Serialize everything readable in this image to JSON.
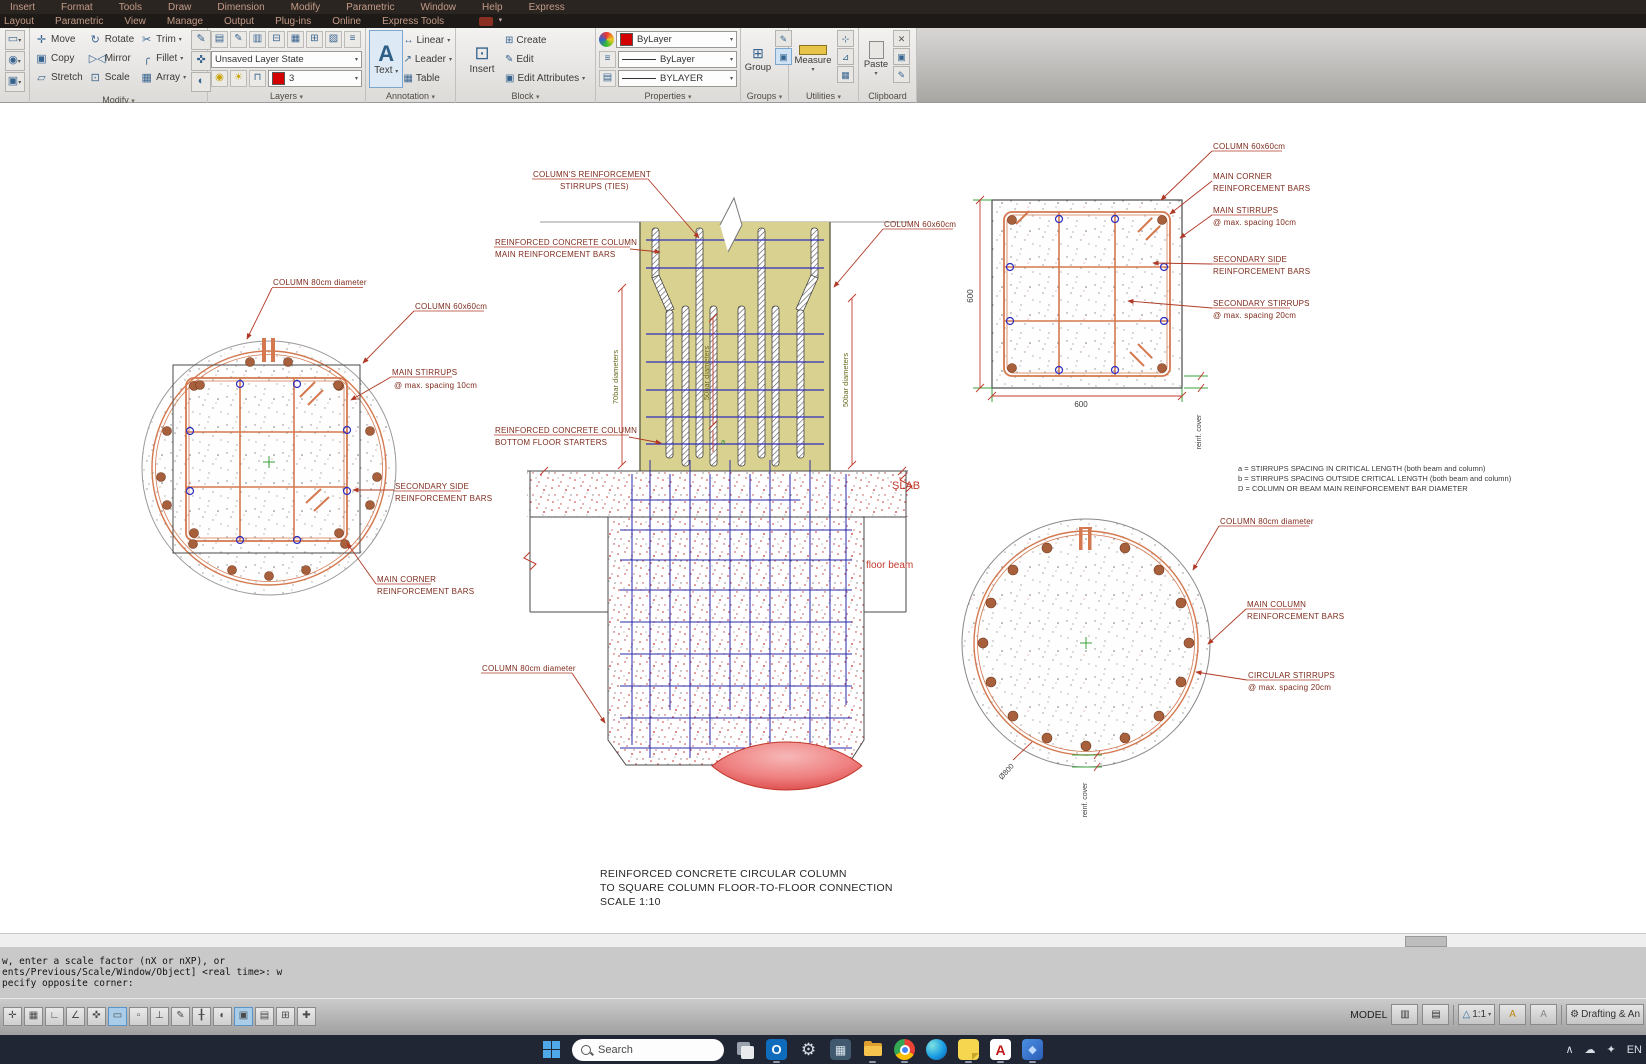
{
  "menubar": {
    "row1": [
      "Insert",
      "Format",
      "Tools",
      "Draw",
      "Dimension",
      "Modify",
      "Parametric",
      "Window",
      "Help",
      "Express"
    ],
    "row2": [
      "Layout",
      "Parametric",
      "View",
      "Manage",
      "Output",
      "Plug-ins",
      "Online",
      "Express Tools"
    ]
  },
  "ribbon": {
    "modify": {
      "label": "Modify",
      "move": "Move",
      "rotate": "Rotate",
      "trim": "Trim",
      "copy": "Copy",
      "mirror": "Mirror",
      "fillet": "Fillet",
      "stretch": "Stretch",
      "scale": "Scale",
      "array": "Array"
    },
    "layers": {
      "label": "Layers",
      "state": "Unsaved Layer State",
      "current": "3"
    },
    "annotation": {
      "label": "Annotation",
      "big_letter": "A",
      "text": "Text",
      "linear": "Linear",
      "leader": "Leader",
      "table": "Table"
    },
    "block": {
      "label": "Block",
      "insert": "Insert",
      "create": "Create",
      "edit": "Edit",
      "edit_attributes": "Edit Attributes"
    },
    "properties": {
      "label": "Properties",
      "color": "ByLayer",
      "linetype": "ByLayer",
      "lineweight": "BYLAYER"
    },
    "groups": {
      "label": "Groups",
      "group": "Group"
    },
    "utilities": {
      "label": "Utilities",
      "measure": "Measure"
    },
    "clipboard": {
      "label": "Clipboard",
      "paste": "Paste"
    }
  },
  "drawing": {
    "left_section": {
      "label_diameter": "COLUMN 80cm diameter",
      "label_column": "COLUMN 60x60cm",
      "label_stirrups1": "MAIN STIRRUPS",
      "label_stirrups2": "@ max. spacing 10cm",
      "label_secondary1": "SECONDARY SIDE",
      "label_secondary2": "REINFORCEMENT BARS",
      "label_corner1": "MAIN CORNER",
      "label_corner2": "REINFORCEMENT BARS"
    },
    "elevation": {
      "label_ties1": "COLUMN'S REINFORCEMENT",
      "label_ties2": "STIRRUPS (TIES)",
      "label_main1": "REINFORCED CONCRETE COLUMN",
      "label_main2": "MAIN REINFORCEMENT BARS",
      "label_column": "COLUMN 60x60cm",
      "label_starters1": "REINFORCED CONCRETE COLUMN",
      "label_starters2": "BOTTOM FLOOR STARTERS",
      "label_column80": "COLUMN 80cm diameter",
      "dim_70": "70bar diameters",
      "dim_50a": "50bar diameters",
      "dim_50b": "50bar diameters",
      "dim_a": "a",
      "slab": "SLAB",
      "floor_beam": "floor beam"
    },
    "square_section": {
      "label_column": "COLUMN 60x60cm",
      "label_corner1": "MAIN CORNER",
      "label_corner2": "REINFORCEMENT BARS",
      "label_stirrups1": "MAIN STIRRUPS",
      "label_stirrups2": "@ max. spacing 10cm",
      "label_secondary1": "SECONDARY SIDE",
      "label_secondary2": "REINFORCEMENT BARS",
      "label_sec_stirrups1": "SECONDARY STIRRUPS",
      "label_sec_stirrups2": "@ max. spacing 20cm",
      "dim_width": "600",
      "dim_height": "600",
      "cover": "reinf. cover"
    },
    "circle_section": {
      "label_diameter": "COLUMN 80cm diameter",
      "label_main1": "MAIN COLUMN",
      "label_main2": "REINFORCEMENT BARS",
      "label_stirrups1": "CIRCULAR STIRRUPS",
      "label_stirrups2": "@ max. spacing 20cm",
      "dim_diameter": "Ø800",
      "cover": "reinf. cover"
    },
    "notes": [
      "a = STIRRUPS SPACING IN CRITICAL LENGTH (both beam and column)",
      "b = STIRRUPS SPACING OUTSIDE CRITICAL LENGTH (both beam and column)",
      "D = COLUMN OR BEAM MAIN REINFORCEMENT BAR DIAMETER"
    ],
    "title": [
      "REINFORCED CONCRETE CIRCULAR COLUMN",
      "TO SQUARE COLUMN FLOOR-TO-FLOOR CONNECTION",
      "SCALE 1:10"
    ]
  },
  "command_line": {
    "lines": [
      "w, enter a scale factor (nX or nXP), or",
      "ents/Previous/Scale/Window/Object] <real time>: w",
      "pecify opposite corner:"
    ]
  },
  "status_bar": {
    "model": "MODEL",
    "scale": "1:1",
    "workspace": "Drafting & An"
  },
  "taskbar": {
    "search": "Search",
    "language": "EN"
  },
  "colors": {
    "accent_red": "#c0392b",
    "leader_red": "#b03a26",
    "khaki": "#d9d18f",
    "stirrup_blue": "#2f2fbe",
    "rebar_orange": "#d4784f",
    "bar_brown": "#a8603c",
    "dim_green": "#3aa03a"
  }
}
